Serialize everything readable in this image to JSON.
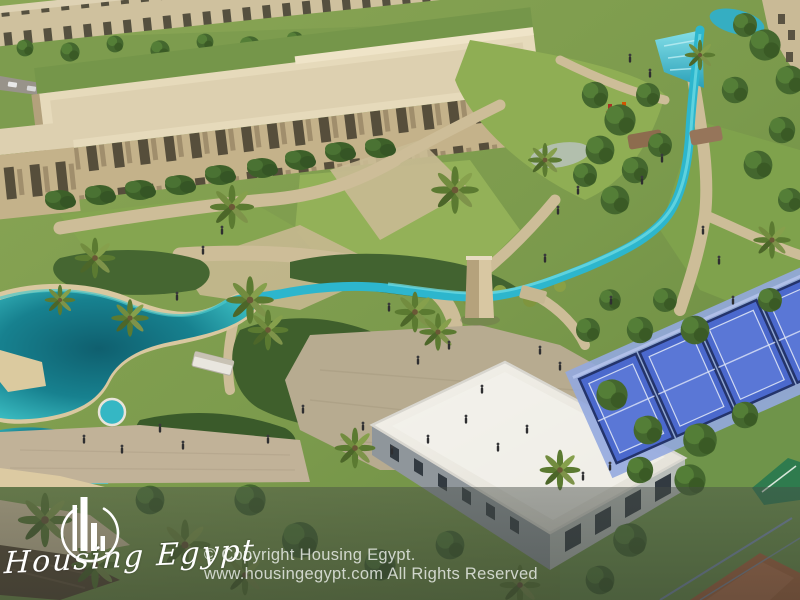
{
  "watermark": {
    "brand_name": "Housing Egypt",
    "copyright_line1": "© Copyright Housing Egypt.",
    "copyright_line2": "www.housingegypt.com All Rights Reserved",
    "logo": "circle-skyline-bars-logo"
  },
  "scene": {
    "type": "aerial-architectural-render",
    "elements": [
      "apartment-buildings",
      "park-lawns",
      "lagoon",
      "stream",
      "waterfall",
      "central-plaza",
      "monument-tower",
      "clubhouse",
      "padel-courts",
      "tennis-court",
      "clay-court",
      "playground",
      "palm-trees",
      "pedestrians"
    ]
  },
  "palette": {
    "water_deep": "#10616f",
    "water_bright": "#2fb9cf",
    "grass": "#7d9c4e",
    "lawn_light": "#93b158",
    "shrub_dark": "#3c5d2b",
    "path_tan": "#cdbd98",
    "building_beige": "#d9cba9",
    "roof_cream": "#e6dabb",
    "clubhouse_roof": "#eceae3",
    "court_blue": "#4b69cd",
    "court_clay": "#b2643c",
    "court_green": "#2f7b4e",
    "watermark_band": "rgba(52,58,53,0.55)",
    "text_white": "#ffffff"
  }
}
